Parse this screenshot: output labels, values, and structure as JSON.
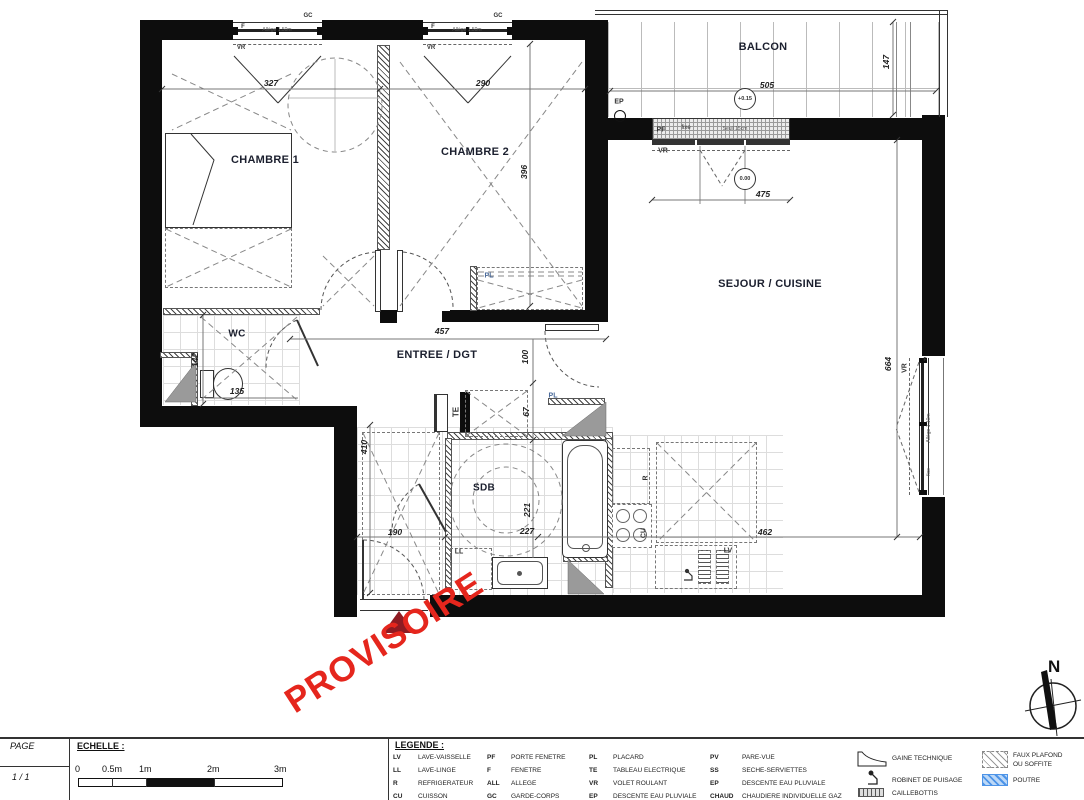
{
  "watermark": {
    "text": "PROVISOIRE",
    "color": "#e5261d"
  },
  "compass": {
    "label": "N"
  },
  "entry_marker_color": "#8e1b22",
  "rooms": {
    "chambre1": "CHAMBRE 1",
    "chambre2": "CHAMBRE 2",
    "balcon": "BALCON",
    "sejour": "SEJOUR / CUISINE",
    "wc": "WC",
    "entree": "ENTREE / DGT",
    "sdb": "SDB"
  },
  "dims": {
    "d327": "327",
    "d290": "290",
    "d396": "396",
    "d505": "505",
    "d147": "147",
    "d475": "475",
    "d457": "457",
    "d100": "100",
    "d67": "67",
    "d142": "142",
    "d135": "135",
    "d410": "410",
    "d190": "190",
    "d221": "221",
    "d227": "227",
    "d462": "462",
    "d664": "664"
  },
  "levels": {
    "balcon": "+0.15",
    "sejour": "0.00"
  },
  "ann": {
    "ep": "EP",
    "pf": "PF",
    "fixe": "fixe",
    "seuil": "Seuil 15cm",
    "vr": "VR",
    "f": "F",
    "gc": "GC",
    "allege150": "Allège 1.50m",
    "allege110": "Allège 1.10m",
    "te": "TE",
    "pl": "PL",
    "ll": "LL",
    "r": "R",
    "cu": "CU",
    "lv": "LV"
  },
  "title_block": {
    "page_label": "PAGE",
    "page_value": "1 / 1",
    "scale_label": "ECHELLE :",
    "scale_ticks": [
      "0",
      "0.5m",
      "1m",
      "2m",
      "3m"
    ],
    "legend_label": "LEGENDE :"
  },
  "legend": {
    "col1": [
      {
        "abbr": "LV",
        "label": "LAVE-VAISSELLE"
      },
      {
        "abbr": "LL",
        "label": "LAVE-LINGE"
      },
      {
        "abbr": "R",
        "label": "REFRIGERATEUR"
      },
      {
        "abbr": "CU",
        "label": "CUISSON"
      }
    ],
    "col2": [
      {
        "abbr": "PF",
        "label": "PORTE FENETRE"
      },
      {
        "abbr": "F",
        "label": "FENETRE"
      },
      {
        "abbr": "ALL",
        "label": "ALLEGE"
      },
      {
        "abbr": "GC",
        "label": "GARDE-CORPS"
      }
    ],
    "col3": [
      {
        "abbr": "PL",
        "label": "PLACARD"
      },
      {
        "abbr": "TE",
        "label": "TABLEAU ELECTRIQUE"
      },
      {
        "abbr": "VR",
        "label": "VOLET ROULANT"
      },
      {
        "abbr": "EP",
        "label": "DESCENTE EAU PLUVIALE"
      }
    ],
    "col4": [
      {
        "abbr": "PV",
        "label": "PARE-VUE"
      },
      {
        "abbr": "SS",
        "label": "SECHE-SERVIETTES"
      },
      {
        "abbr": "EP",
        "label": "DESCENTE EAU PLUVIALE"
      },
      {
        "abbr": "CHAUD",
        "label": "CHAUDIERE INDIVIDUELLE GAZ"
      }
    ],
    "symbols": [
      {
        "name": "gaine-technique",
        "label": "GAINE TECHNIQUE"
      },
      {
        "name": "robinet-de-puisage",
        "label": "ROBINET DE PUISAGE"
      },
      {
        "name": "caillebottis",
        "label": "CAILLEBOTTIS"
      }
    ],
    "swatches": [
      {
        "name": "faux-plafond",
        "label1": "FAUX PLAFOND",
        "label2": "OU SOFFITE"
      },
      {
        "name": "poutre",
        "label": "POUTRE",
        "color": "#4d94e8"
      }
    ]
  }
}
